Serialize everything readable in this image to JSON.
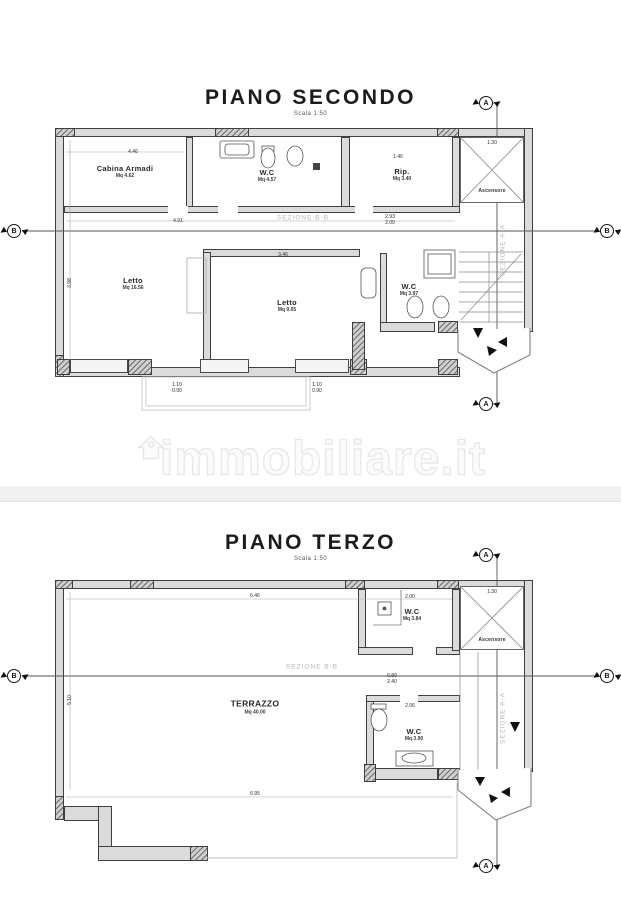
{
  "watermark": {
    "text": "immobiliare.it"
  },
  "plans": [
    {
      "title": "PIANO SECONDO",
      "scale": "Scala 1:50",
      "rooms": [
        {
          "name": "Cabina Armadi",
          "area": "Mq 4.62"
        },
        {
          "name": "W.C",
          "area": "Mq 4.57"
        },
        {
          "name": "Rip.",
          "area": "Mq 3.40"
        },
        {
          "name": "Letto",
          "area": "Mq 16.56"
        },
        {
          "name": "Letto",
          "area": "Mq 9.05"
        },
        {
          "name": "W.C",
          "area": "Mq 3.97"
        }
      ],
      "elevator": "Ascensore",
      "section_h": "SEZIONE B-B",
      "section_v": "SEZIONE A-A",
      "markers": {
        "a": "A",
        "b": "B"
      },
      "dims": [
        "4.46",
        "1.46",
        "4.91",
        "3.98",
        "3.46",
        "2.93",
        "2.00",
        "1.10",
        "0.90",
        "1.10",
        "0.90",
        "1.30"
      ]
    },
    {
      "title": "PIANO TERZO",
      "scale": "Scala 1:50",
      "rooms": [
        {
          "name": "W.C",
          "area": "Mq 3.84"
        },
        {
          "name": "TERRAZZO",
          "area": "Mq 40.00"
        },
        {
          "name": "W.C",
          "area": "Mq 3.90"
        }
      ],
      "elevator": "Ascensore",
      "section_h": "SEZIONE B-B",
      "section_v": "SEZIONE A-A",
      "markers": {
        "a": "A",
        "b": "B"
      },
      "dims": [
        "6.46",
        "2.00",
        "2.06",
        "0.80",
        "2.40",
        "6.95",
        "5.10",
        "1.30"
      ]
    }
  ],
  "colors": {
    "wall_fill": "#dbdbdb",
    "line": "#3f3f3f",
    "section_gray": "#b5b5b5",
    "watermark": "#fbfbfb"
  }
}
